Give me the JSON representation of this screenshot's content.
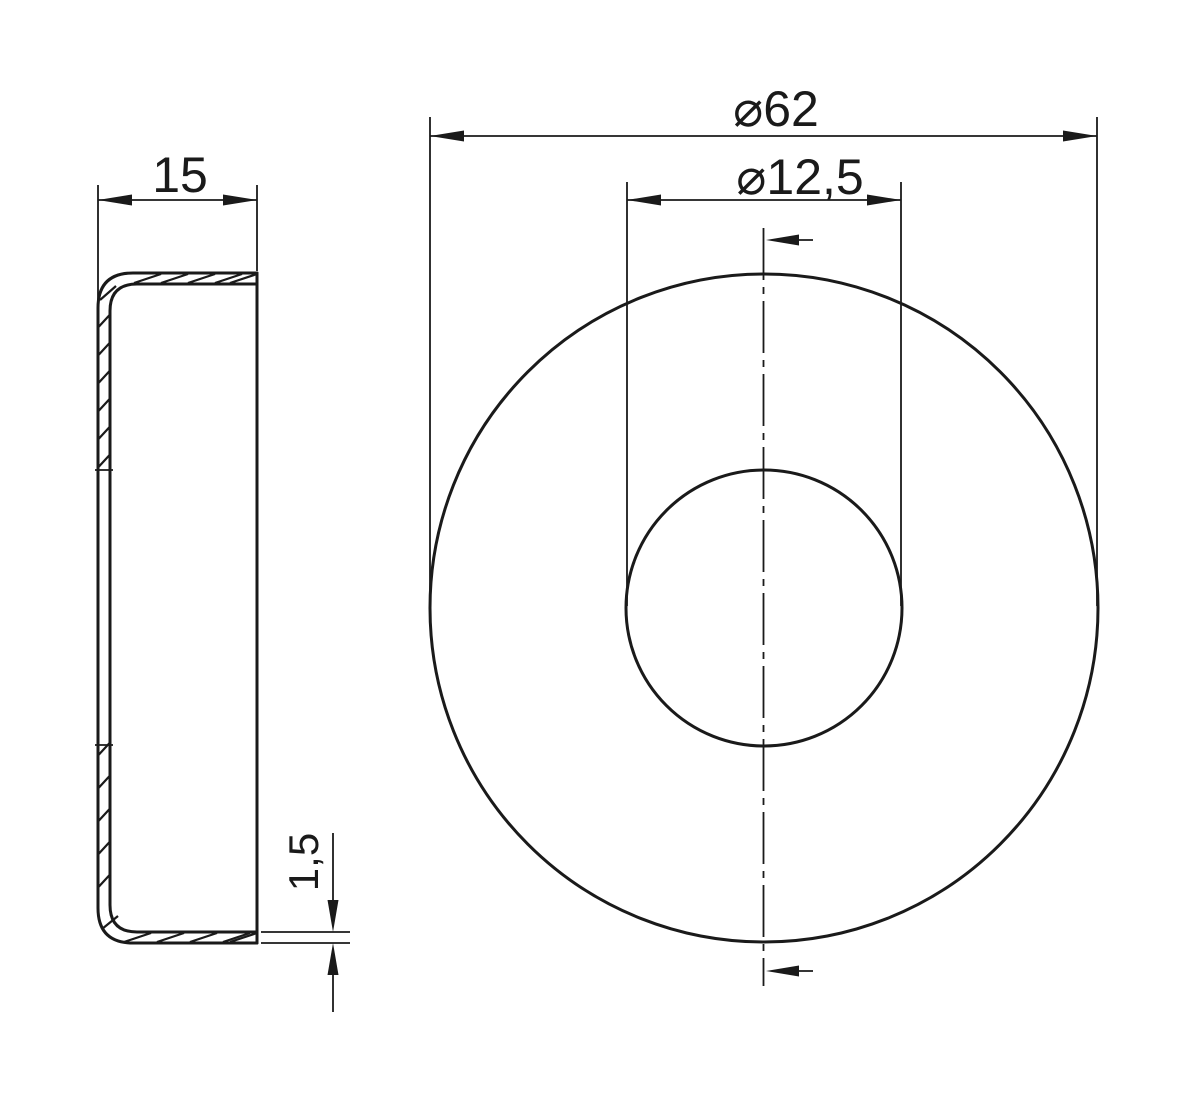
{
  "drawing": {
    "title": "cap-section-and-front-view",
    "background_color": "#ffffff",
    "line_color": "#1a1a1a",
    "dimensions": {
      "width": {
        "label": "15",
        "value": 15
      },
      "outer_diameter": {
        "label": "⌀62",
        "value": 62
      },
      "hole_diameter": {
        "label": "⌀12,5",
        "value": 12.5
      },
      "wall_thickness": {
        "label": "1,5",
        "value": 1.5
      }
    }
  }
}
